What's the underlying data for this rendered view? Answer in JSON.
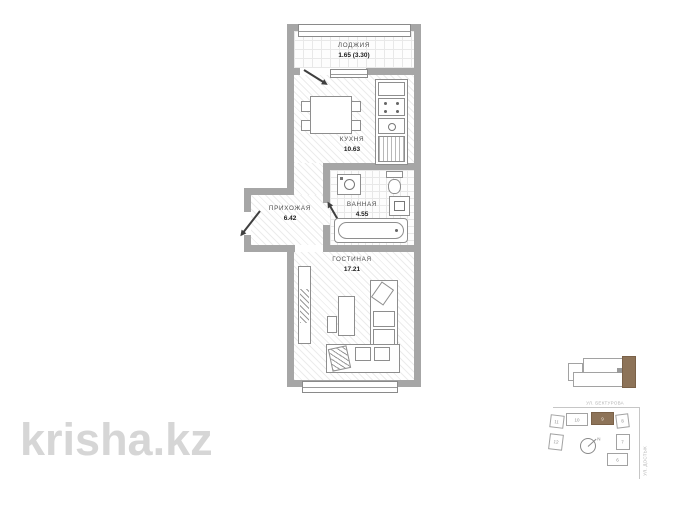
{
  "watermark": {
    "text": "krisha.kz"
  },
  "plan": {
    "rooms": {
      "loggia": {
        "label": "ЛОДЖИЯ",
        "area": "1.65 (3.30)"
      },
      "kitchen": {
        "label": "КУХНЯ",
        "area": "10.63"
      },
      "hallway": {
        "label": "ПРИХОЖАЯ",
        "area": "6.42"
      },
      "bathroom": {
        "label": "ВАННАЯ",
        "area": "4.55"
      },
      "living": {
        "label": "ГОСТИНАЯ",
        "area": "17.21"
      }
    }
  },
  "site_plan": {
    "street_top": "УЛ. БЕКТУРОВА",
    "street_right": "УЛ. ДОСТЫК",
    "compass_label": "N",
    "buildings": [
      {
        "number": "11",
        "highlighted": false
      },
      {
        "number": "10",
        "highlighted": false
      },
      {
        "number": "9",
        "highlighted": true
      },
      {
        "number": "8",
        "highlighted": false
      },
      {
        "number": "12",
        "highlighted": false
      },
      {
        "number": "7",
        "highlighted": false
      },
      {
        "number": "6",
        "highlighted": false
      }
    ],
    "colors": {
      "highlight": "#8d7358"
    }
  },
  "colors": {
    "wall": "#a6a6a6",
    "watermark": "#d6d6d6"
  }
}
